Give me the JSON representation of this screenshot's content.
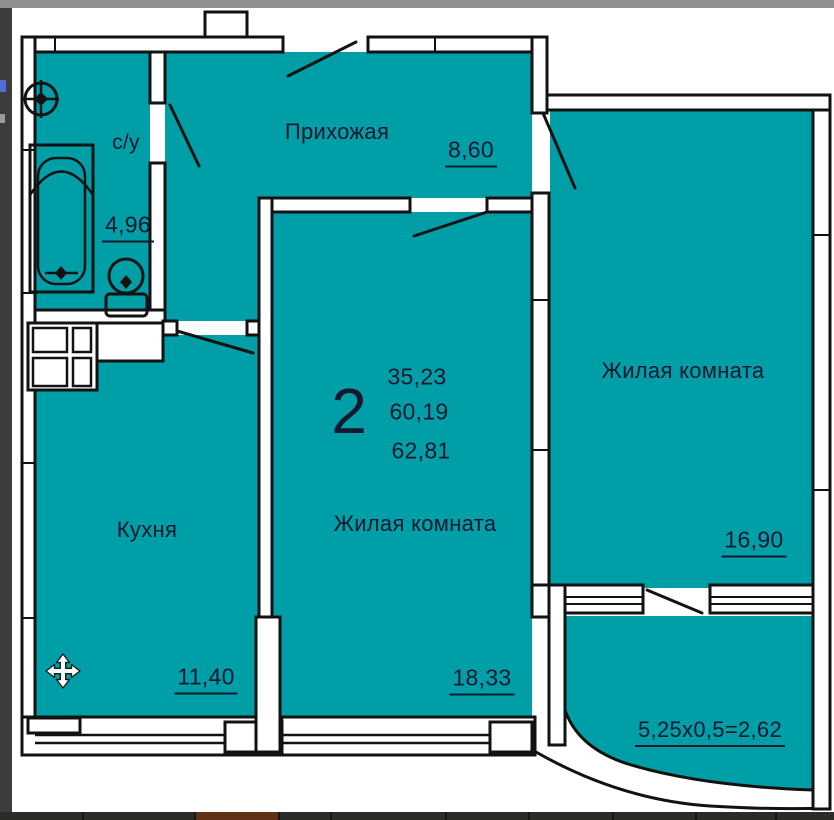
{
  "plan": {
    "colors": {
      "floor": "#009FA7",
      "wall_line": "#121212",
      "text": "#17172f",
      "page_background": "#ffffff"
    },
    "summary": {
      "rooms_count": "2",
      "living_area": "35,23",
      "apartment_area": "60,19",
      "total_area": "62,81"
    },
    "rooms": {
      "bathroom": {
        "name": "с/у",
        "area": "4,96"
      },
      "hallway": {
        "name": "Прихожая",
        "area": "8,60"
      },
      "kitchen": {
        "name": "Кухня",
        "area": "11,40"
      },
      "living_room_center": {
        "name": "Жилая комната",
        "area": "18,33"
      },
      "living_room_right": {
        "name": "Жилая комната",
        "area": "16,90"
      },
      "balcony": {
        "area_formula": "5,25x0,5=2,62"
      }
    },
    "fixtures": [
      "bathtub",
      "sink",
      "toilet",
      "washer-grid"
    ],
    "cursor": {
      "type": "move"
    }
  },
  "frame": {
    "top_strip_color": "#909090",
    "left_strip_color": "#3c3c3c",
    "taskbar_color": "#2b2b28",
    "taskbar_accent_color": "#5f3115"
  }
}
